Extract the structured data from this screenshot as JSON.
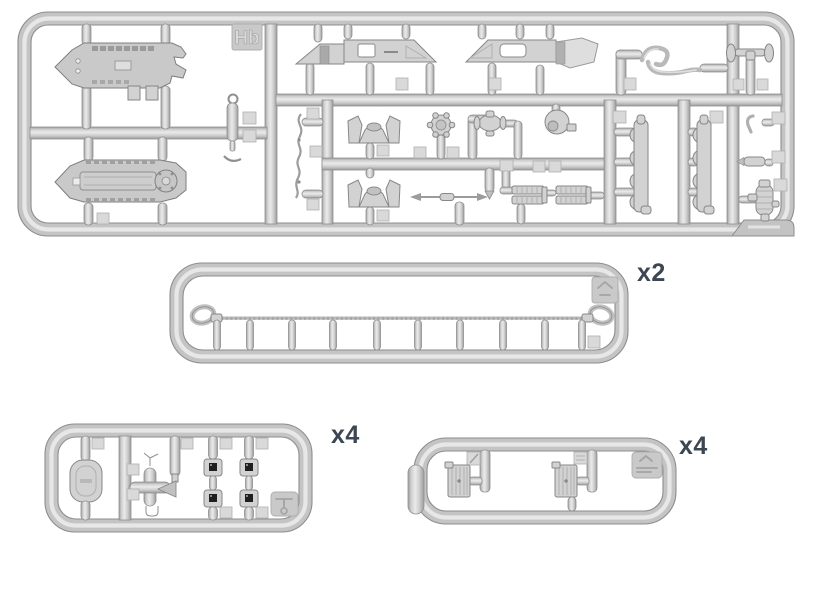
{
  "page": {
    "width": 820,
    "height": 615,
    "background": "#ffffff"
  },
  "palette": {
    "plastic_base": "#c4c4c4",
    "plastic_highlight": "#e7e7e7",
    "plastic_edge": "#8d8d8d",
    "part_fill": "#d2d2d2",
    "periscope_lens": "#1f1f1f",
    "label_color": "#3d4653"
  },
  "sprues": {
    "main": {
      "marking": "Hb"
    },
    "cable": {
      "quantity": "x2"
    },
    "small_left": {
      "quantity": "x4"
    },
    "small_right": {
      "quantity": "x4"
    }
  }
}
